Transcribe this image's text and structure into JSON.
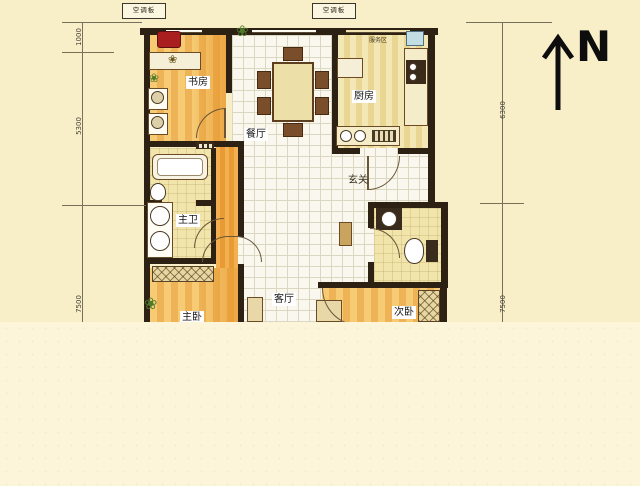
{
  "compass": {
    "label": "N"
  },
  "ac_panels": {
    "left": "空调板",
    "right": "空调板"
  },
  "dims": {
    "left": [
      "1000",
      "5300",
      "7500"
    ],
    "right": [
      "6300",
      "7500"
    ]
  },
  "rooms": {
    "study": {
      "label": "书房"
    },
    "dining": {
      "label": "餐厅"
    },
    "kitchen": {
      "label": "厨房"
    },
    "service_area": {
      "label": "服务区"
    },
    "entry": {
      "label": "玄关"
    },
    "master_bath": {
      "label": "主卫"
    },
    "living": {
      "label": "客厅"
    },
    "master_bedroom": {
      "label": "主卧"
    },
    "second_bedroom": {
      "label": "次卧"
    }
  },
  "colors": {
    "wall": "#2d2114",
    "background_upper": "#f8efc8",
    "background_lower": "#fcf5da",
    "wood_light": "#f6cb74",
    "wood_dark": "#edb356",
    "tile_line": "#dcd7c1",
    "kitchen_floor": "#f0df9d",
    "accent_red": "#a91f1f",
    "sink_blue": "#c2dee4"
  }
}
